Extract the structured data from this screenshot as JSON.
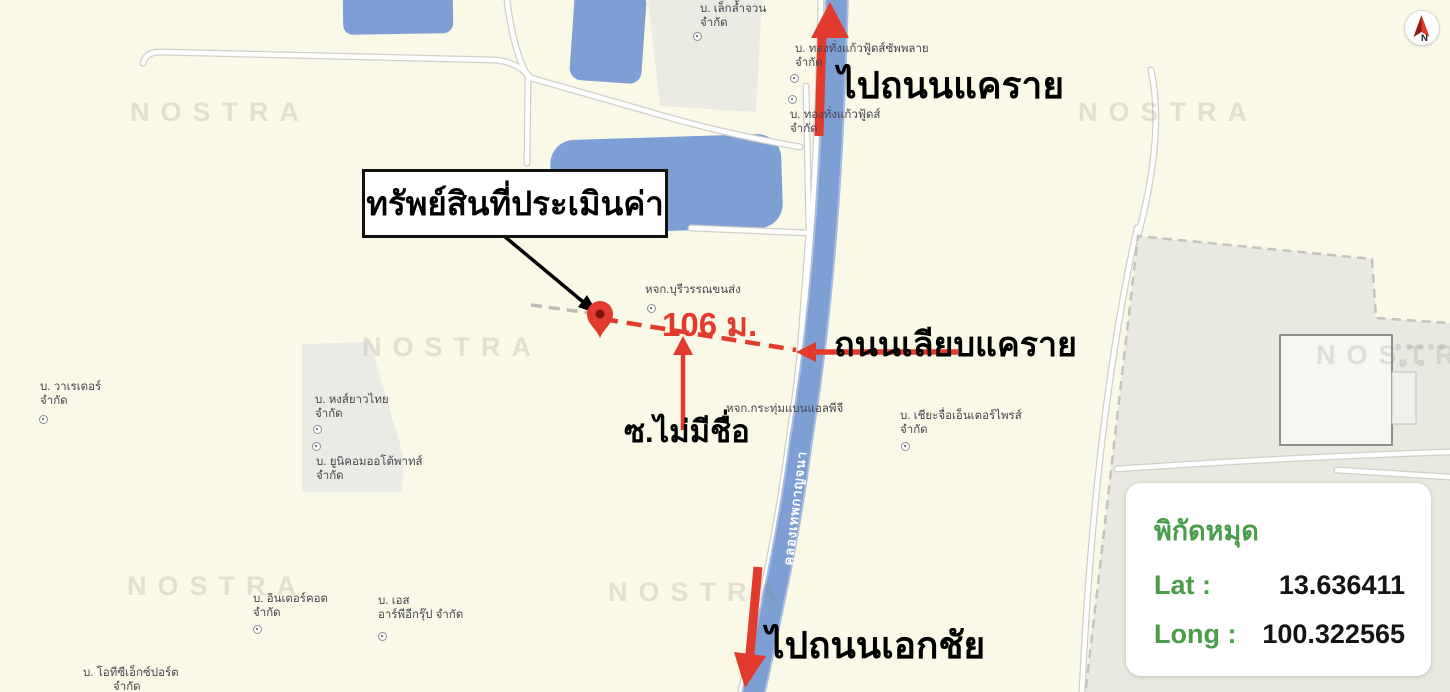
{
  "map": {
    "watermark": "NOSTRA",
    "canal_label": "คลองเทพกาญจนา",
    "annotations": {
      "callout": "ทรัพย์สินที่ประเมินค่า",
      "distance": "106 ม.",
      "to_road_north": "ไปถนนแคราย",
      "to_road_south": "ไปถนนเอกชัย",
      "road_along_canal": "ถนนเลียบแคราย",
      "unnamed_soi": "ซ.ไม่มีชื่อ"
    },
    "places": [
      {
        "line1": "บ. เล็กล้ำจวน",
        "line2": "จำกัด"
      },
      {
        "line1": "บ. ทองทั่งแก้วฟู้ดส์ซัพพลาย",
        "line2": "จำกัด"
      },
      {
        "line1": "บ. ทองทั่งแก้วฟู้ดส์",
        "line2": "จำกัด"
      },
      {
        "line1": "หจก.บุรีวรรณขนส่ง",
        "line2": ""
      },
      {
        "line1": "หจก.กระทุ่มแบนแอลพีจี",
        "line2": ""
      },
      {
        "line1": "บ. เชียะจื่อเอ็นเตอร์ไพรส์",
        "line2": "จำกัด"
      },
      {
        "line1": "บ. วาเรเดอร์",
        "line2": "จำกัด"
      },
      {
        "line1": "บ. หงส์ยาวไทย",
        "line2": "จำกัด"
      },
      {
        "line1": "บ. ยูนิคอมออโต้พาทส์",
        "line2": "จำกัด"
      },
      {
        "line1": "บ. อินเตอร์คอด",
        "line2": "จำกัด"
      },
      {
        "line1": "บ. เอส",
        "line2": "อาร์พีอีกรุ๊ป จำกัด"
      },
      {
        "line1": "บ. โอทีซีเอ็กซ์ปอร์ต",
        "line2": "จำกัด"
      }
    ]
  },
  "coords_card": {
    "title": "พิกัดหมุด",
    "lat_label": "Lat :",
    "lat_value": "13.636411",
    "long_label": "Long :",
    "long_value": "100.322565"
  },
  "compass": {
    "north_label": "N"
  },
  "colors": {
    "background": "#faf9e7",
    "water_blue": "#7d9fd3",
    "accent_red": "#e23b2e",
    "card_green": "#4a9e4a"
  }
}
